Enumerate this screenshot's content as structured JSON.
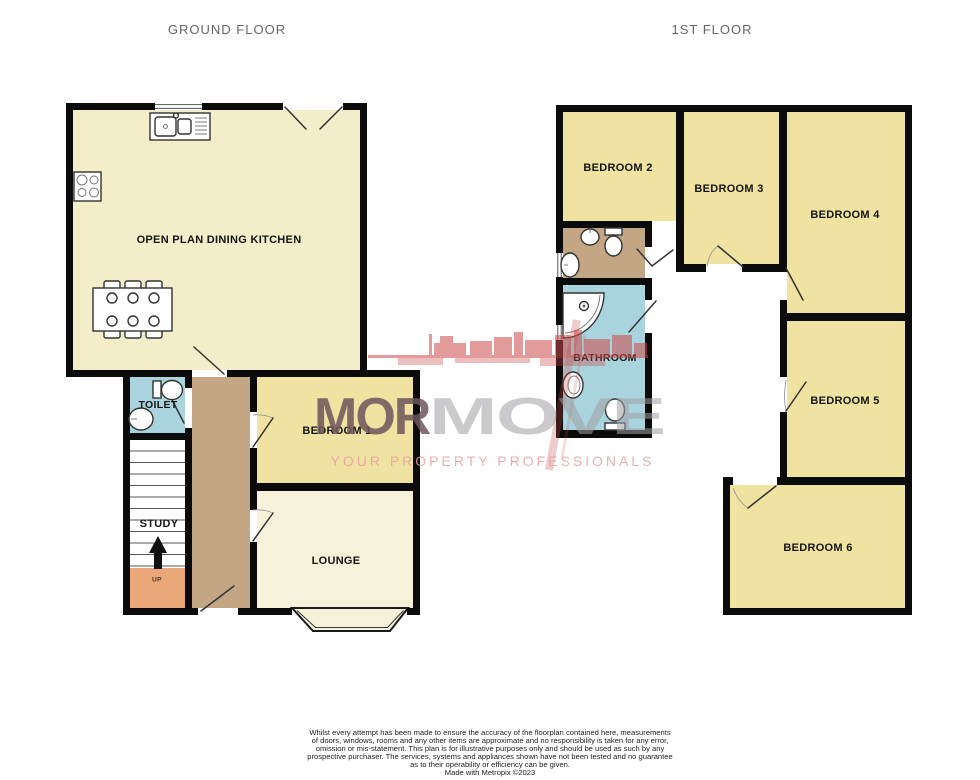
{
  "titles": {
    "ground": "GROUND FLOOR",
    "first": "1ST FLOOR"
  },
  "rooms": {
    "kitchen": "OPEN PLAN DINING KITCHEN",
    "toilet": "TOILET",
    "study": "STUDY",
    "up": "UP",
    "bedroom1": "BEDROOM 1",
    "lounge": "LOUNGE",
    "bedroom2": "BEDROOM 2",
    "bedroom3": "BEDROOM 3",
    "bedroom4": "BEDROOM 4",
    "bedroom5": "BEDROOM 5",
    "bedroom6": "BEDROOM 6",
    "bathroom": "BATHROOM"
  },
  "watermark": {
    "brand_left": "MOR",
    "brand_right": "MOVE",
    "tagline": "YOUR PROPERTY PROFESSIONALS"
  },
  "disclaimer": {
    "line1": "Whilst every attempt has been made to ensure the accuracy of the floorplan contained here, measurements",
    "line2": "of doors, windows, rooms and any other items are approximate and no responsibility is taken for any error,",
    "line3": "omission or mis-statement. This plan is for illustrative purposes only and should be used as such by any",
    "line4": "prospective purchaser. The services, systems and appliances shown have not been tested and no guarantee",
    "line5": "as to their operability or efficiency can be given.",
    "credit": "Made with Metropix ©2023"
  },
  "colors": {
    "wall": "#0b0b0b",
    "kitchen-fill": "#f4edca",
    "lounge-fill": "#f6f1d9",
    "bedroom-fill": "#f0e2a1",
    "wet-fill": "#aad4dd",
    "hall-fill": "#c3a785",
    "up-fill": "#eaa878",
    "title-text": "#666666",
    "label-text": "#141414",
    "brand-left": "#6e565c",
    "brand-right": "#a0a0a5",
    "tagline": "#e8a0a4",
    "skyline": "#cb4848"
  }
}
